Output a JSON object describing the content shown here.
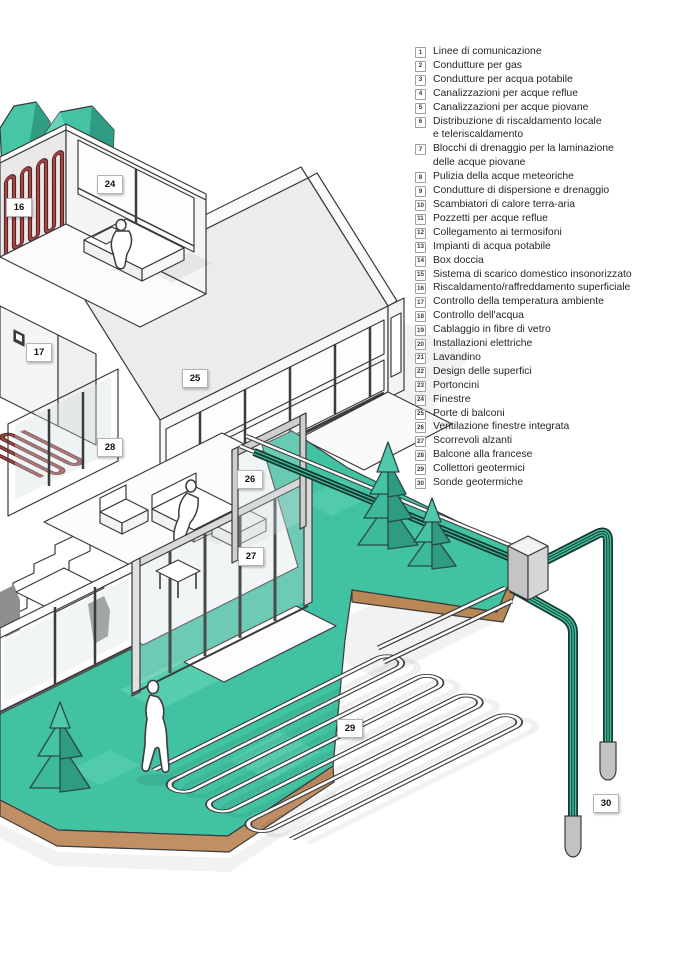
{
  "legend": {
    "items": [
      {
        "num": "1",
        "label": "Linee di comunicazione"
      },
      {
        "num": "2",
        "label": "Condutture per gas"
      },
      {
        "num": "3",
        "label": "Condutture per acqua potabile"
      },
      {
        "num": "4",
        "label": "Canalizzazioni per acque reflue"
      },
      {
        "num": "5",
        "label": "Canalizzazioni per acque piovane"
      },
      {
        "num": "6",
        "label": "Distribuzione di riscaldamento locale",
        "label2": "e teleriscaldamento"
      },
      {
        "num": "7",
        "label": "Blocchi di drenaggio per la laminazione",
        "label2": "delle acque piovane"
      },
      {
        "num": "8",
        "label": "Pulizia della acque meteoriche"
      },
      {
        "num": "9",
        "label": "Condutture di dispersione e drenaggio"
      },
      {
        "num": "10",
        "label": "Scambiatori di calore terra-aria"
      },
      {
        "num": "11",
        "label": "Pozzetti per acque reflue"
      },
      {
        "num": "12",
        "label": "Collegamento ai termosifoni"
      },
      {
        "num": "13",
        "label": "Impianti di acqua potabile"
      },
      {
        "num": "14",
        "label": "Box doccia"
      },
      {
        "num": "15",
        "label": "Sistema di scarico domestico insonorizzato"
      },
      {
        "num": "16",
        "label": "Riscaldamento/raffreddamento superficiale"
      },
      {
        "num": "17",
        "label": "Controllo della temperatura ambiente"
      },
      {
        "num": "18",
        "label": "Controllo dell'acqua"
      },
      {
        "num": "19",
        "label": "Cablaggio in fibre di vetro"
      },
      {
        "num": "20",
        "label": "Installazioni elettriche"
      },
      {
        "num": "21",
        "label": "Lavandino"
      },
      {
        "num": "22",
        "label": "Design delle superfici"
      },
      {
        "num": "23",
        "label": "Portoncini"
      },
      {
        "num": "24",
        "label": "Finestre"
      },
      {
        "num": "25",
        "label": "Porte di balconi"
      },
      {
        "num": "26",
        "label": "Ventilazione finestre integrata"
      },
      {
        "num": "27",
        "label": "Scorrevoli alzanti"
      },
      {
        "num": "28",
        "label": "Balcone alla francese"
      },
      {
        "num": "29",
        "label": "Collettori geotermici"
      },
      {
        "num": "30",
        "label": "Sonde geotermiche"
      }
    ]
  },
  "markers": [
    {
      "num": "16"
    },
    {
      "num": "24"
    },
    {
      "num": "17"
    },
    {
      "num": "25"
    },
    {
      "num": "28"
    },
    {
      "num": "26"
    },
    {
      "num": "27"
    },
    {
      "num": "29"
    },
    {
      "num": "30"
    }
  ],
  "colors": {
    "lawn_teal": "#41C2A3",
    "teal_dark": "#2E9B82",
    "teal_light": "#63D4B6",
    "soil_brown": "#C08F63",
    "pipe_dark_green": "#16382E",
    "pipe_teal": "#3FC3A3",
    "heating_red": "#9E3A39",
    "outline_gray": "#3B3B3B"
  }
}
